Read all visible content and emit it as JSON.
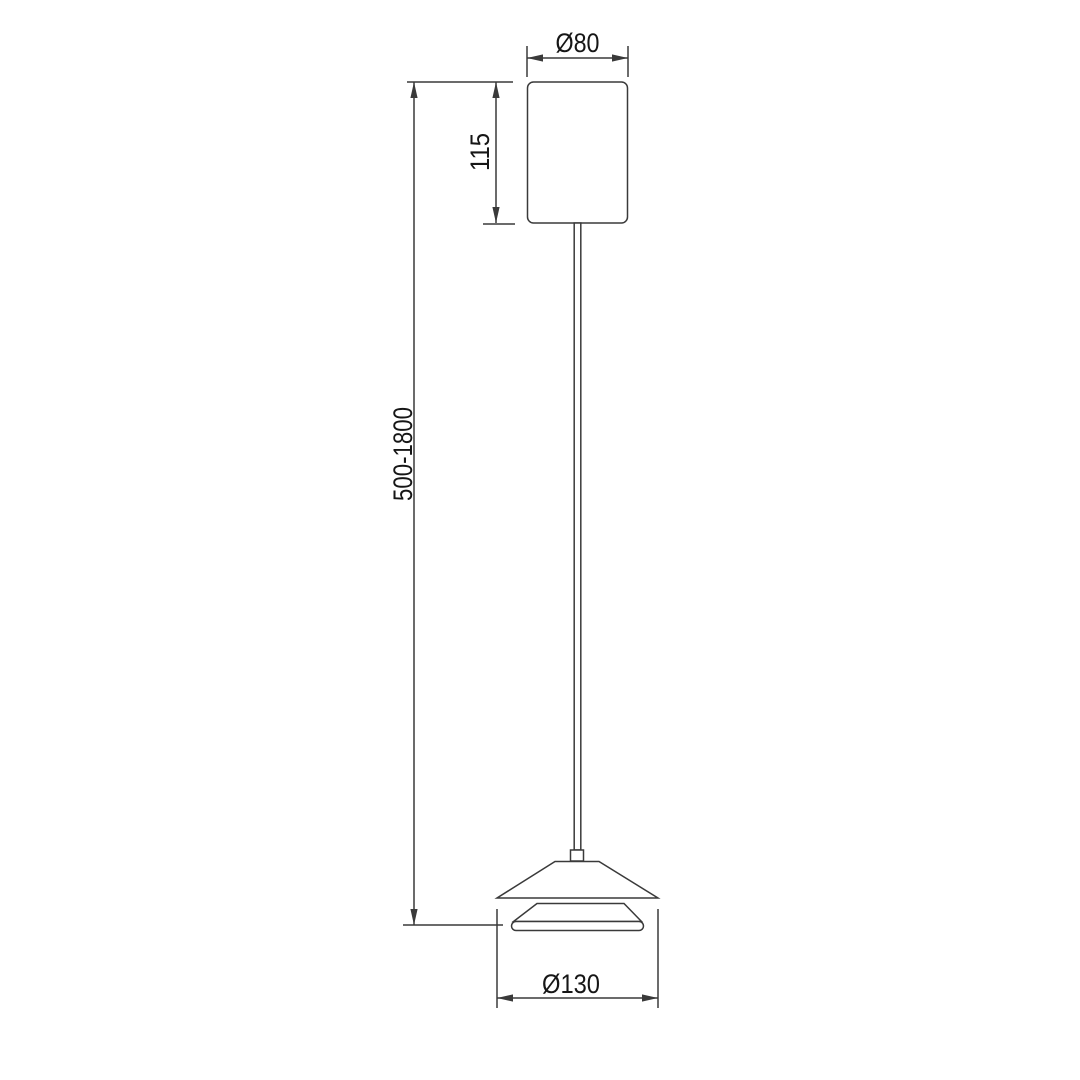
{
  "drawing": {
    "name": "pendant-lamp-dimension-drawing",
    "labels": {
      "canopy_diameter": "Ø80",
      "canopy_height": "115",
      "suspension_length": "500-1800",
      "shade_diameter": "Ø130"
    },
    "colors": {
      "line": "#3a3a3a",
      "text": "#161616",
      "background": "#ffffff"
    }
  }
}
